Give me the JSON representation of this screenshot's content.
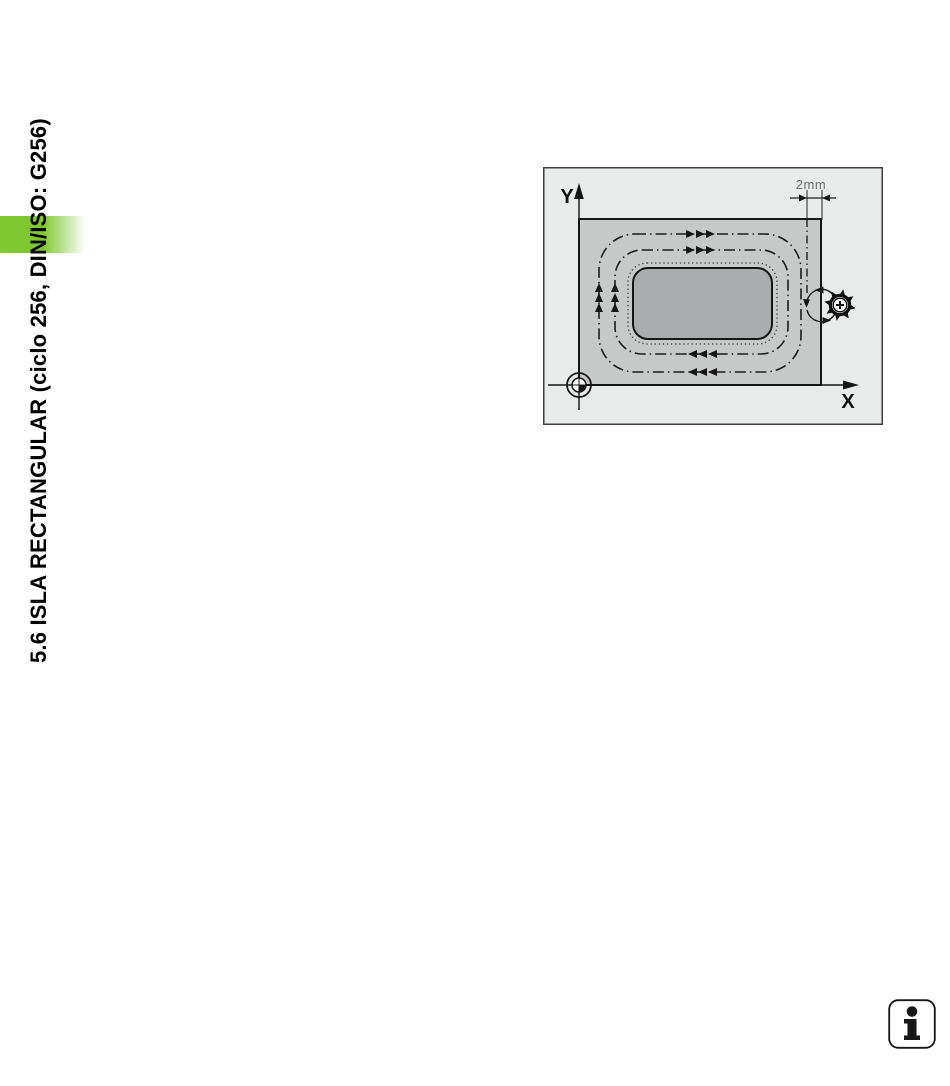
{
  "chapter": {
    "title": "5.6 ISLA RECTANGULAR (ciclo 256, DIN/ISO: G256)",
    "tab_color": "#80c832"
  },
  "diagram": {
    "axis_y": "Y",
    "axis_x": "X",
    "dimension": "2mm",
    "colors": {
      "background": "#e9eaea",
      "border": "#3c3c3c",
      "workpiece": "#c7c8c8",
      "island": "#abacad",
      "outline": "#161616",
      "dimension_text": "#6e6e72"
    }
  },
  "info_icon": {
    "glyph": "i"
  }
}
